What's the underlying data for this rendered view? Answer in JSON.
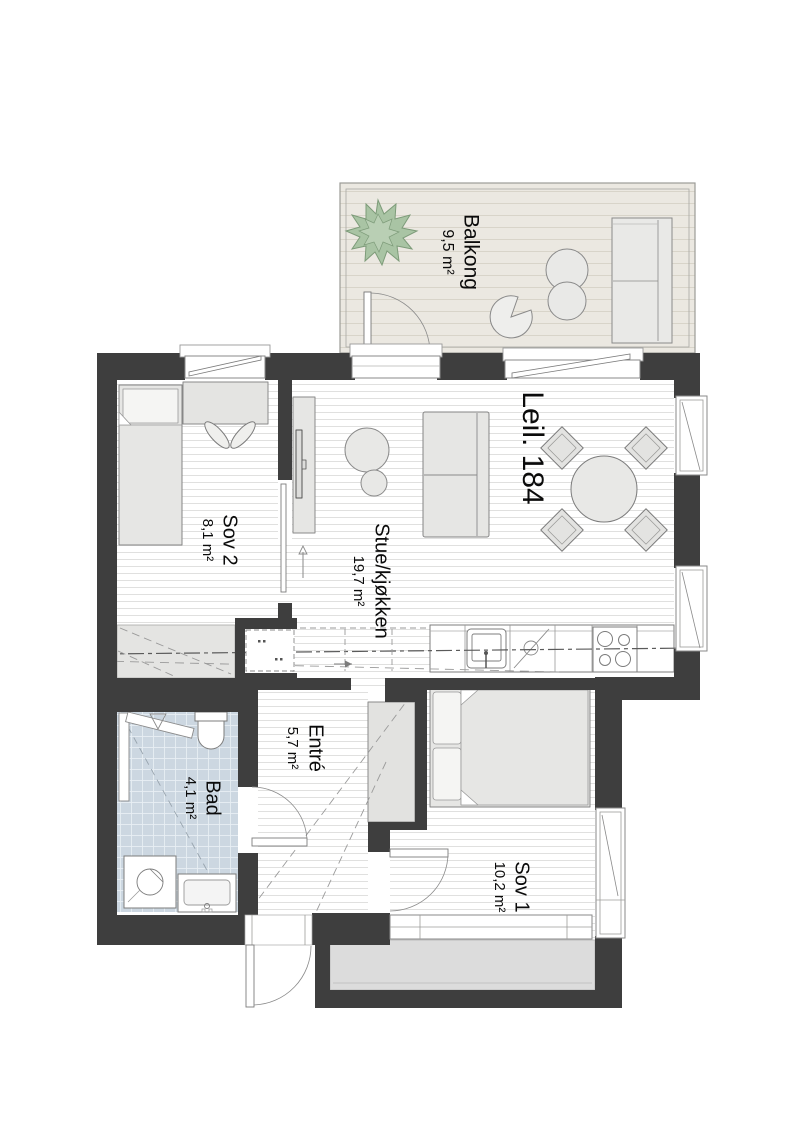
{
  "plan": {
    "apartment_label": "Leil. 184",
    "rooms": {
      "balkong": {
        "name": "Balkong",
        "area": "9,5 m²"
      },
      "stue": {
        "name": "Stue/kjøkken",
        "area": "19,7 m²"
      },
      "sov2": {
        "name": "Sov 2",
        "area": "8,1 m²"
      },
      "entre": {
        "name": "Entré",
        "area": "5,7 m²"
      },
      "bad": {
        "name": "Bad",
        "area": "4,1 m²"
      },
      "sov1": {
        "name": "Sov 1",
        "area": "10,2 m²"
      }
    },
    "colors": {
      "wall": "#3e3e3e",
      "floor_line": "#e0e0df",
      "balcony_floor": "#ebe8e1",
      "bath_tile": "#ccd7e1",
      "plant": "#a9c4a4",
      "furniture": "#e6e6e4",
      "access_balcony": "#dcdcdc"
    }
  }
}
